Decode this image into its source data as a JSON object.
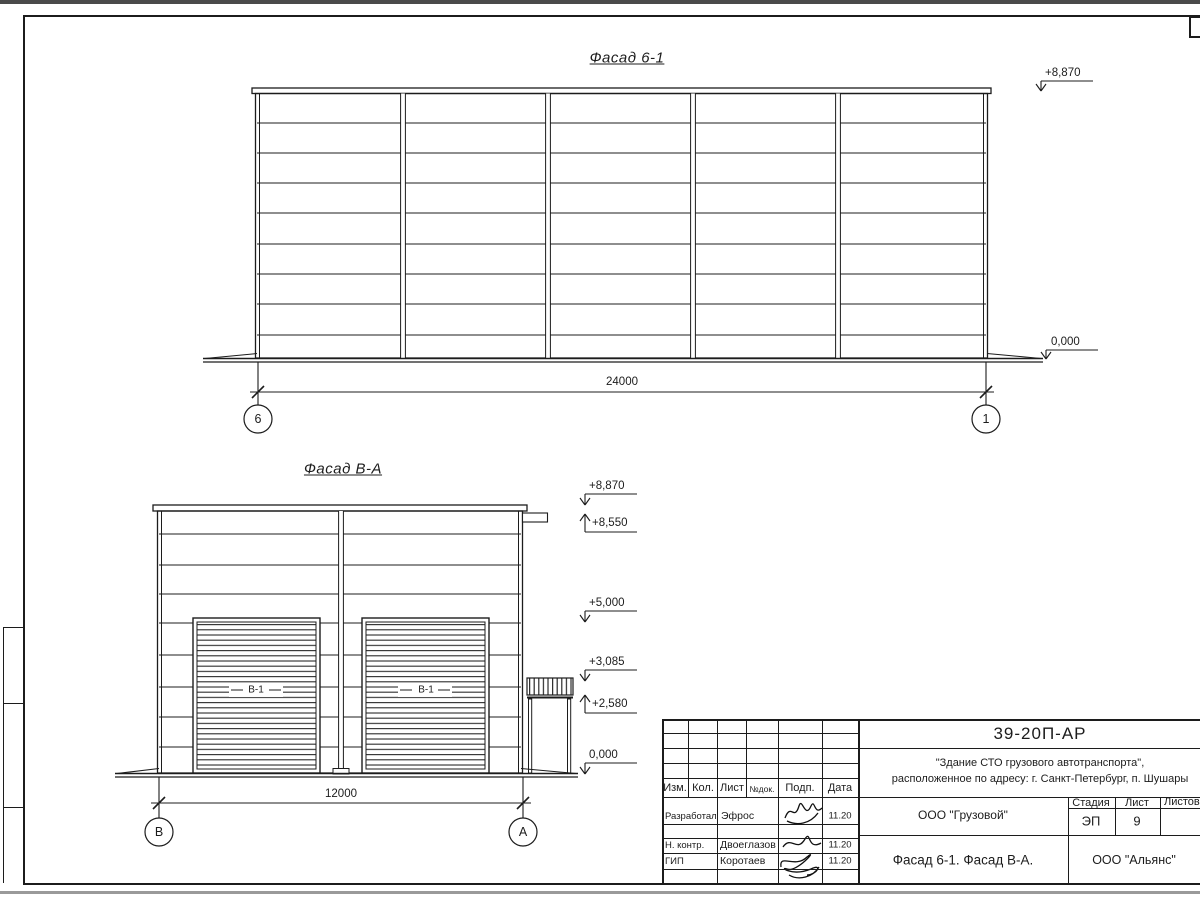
{
  "drawing": {
    "facade1": {
      "title": "Фасад 6-1",
      "elev_top": "+8,870",
      "elev_ground": "0,000",
      "dim": "24000",
      "axis_left": "6",
      "axis_right": "1"
    },
    "facade2": {
      "title": "Фасад В-А",
      "elev": [
        "+8,870",
        "+8,550",
        "+5,000",
        "+3,085",
        "+2,580",
        "0,000"
      ],
      "dim": "12000",
      "axis_left": "В",
      "axis_right": "А",
      "door_label": "В-1"
    },
    "stamp": {
      "doc": "39-20П-АР",
      "project1": "\"Здание СТО грузового автотранспорта\",",
      "project2": "расположенное по адресу: г. Санкт-Петербург, п. Шушары",
      "org": "ООО \"Грузовой\"",
      "views": "Фасад 6-1. Фасад В-А.",
      "company": "ООО \"Альянс\"",
      "stage_label": "Стадия",
      "list_label": "Лист",
      "listov_label": "Листов",
      "stage": "ЭП",
      "list_no": "9",
      "col_izm": "Изм.",
      "col_kol": "Кол.",
      "col_list": "Лист",
      "col_ndok": "№док.",
      "col_podp": "Подп.",
      "col_data": "Дата",
      "row1_role": "Разработал",
      "row1_name": "Эфрос",
      "row1_date": "11.20",
      "row2_role": "Н. контр.",
      "row2_name": "Двоеглазов",
      "row2_date": "11.20",
      "row3_role": "ГИП",
      "row3_name": "Коротаев",
      "row3_date": "11.20"
    }
  }
}
